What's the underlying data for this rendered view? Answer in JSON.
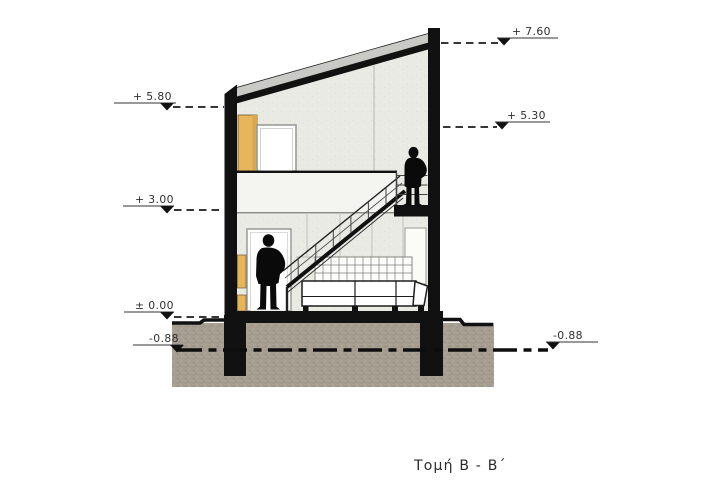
{
  "title": {
    "text": "Τομή  B - B΄"
  },
  "levels": [
    {
      "id": "plus-7-60",
      "label": "+ 7.60",
      "side": "right"
    },
    {
      "id": "plus-5-80",
      "label": "+ 5.80",
      "side": "left"
    },
    {
      "id": "plus-5-30",
      "label": "+ 5.30",
      "side": "right"
    },
    {
      "id": "plus-3-00",
      "label": "+ 3.00",
      "side": "left"
    },
    {
      "id": "zero-0-00",
      "label": "± 0.00",
      "side": "left"
    },
    {
      "id": "minus-0-88-left",
      "label": "-0.88",
      "side": "left"
    },
    {
      "id": "minus-0-88-right",
      "label": "-0.88",
      "side": "right"
    }
  ],
  "colors": {
    "ink": "#111111",
    "paper": "#ffffff",
    "wall_fill": "#eaeae5",
    "parapet_fill": "#f4f4f0",
    "roof_slab": "#c9c9c6",
    "ground": "#a69e91",
    "wardrobe": "#e6b55c",
    "cabinet": "#e6b55c",
    "frame_grey": "#9a9a96"
  }
}
